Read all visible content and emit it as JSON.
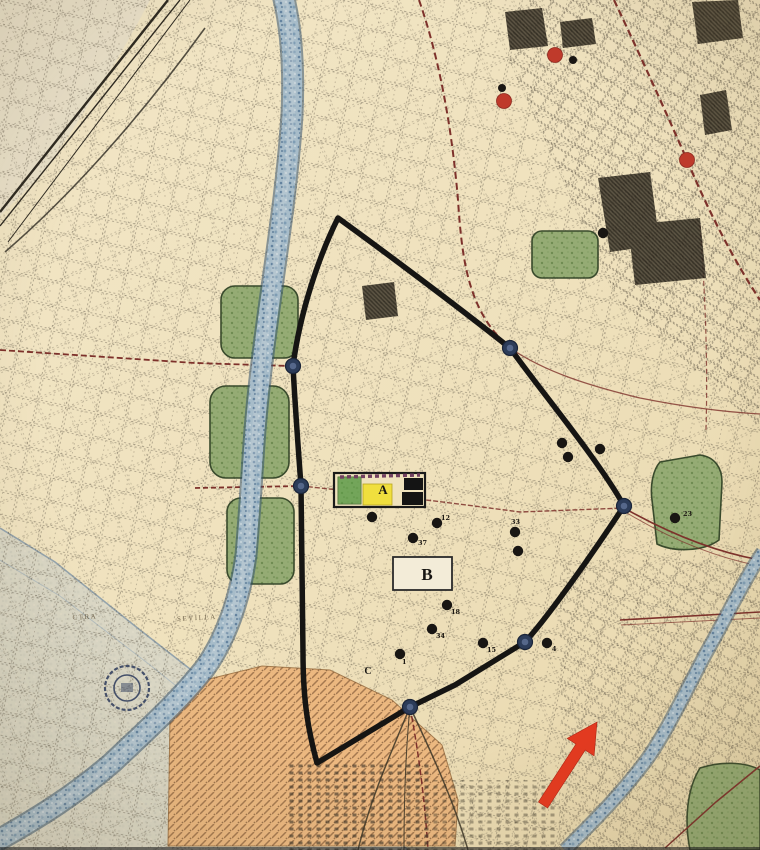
{
  "map": {
    "description": "scanned historical city map with walled old town outlined in black, river, riverside parks, annotated sites and a red arrow annotation",
    "letter_labels": [
      {
        "text": "A",
        "x": 383,
        "y": 494,
        "size": 13
      },
      {
        "text": "B",
        "x": 427,
        "y": 580,
        "size": 17
      },
      {
        "text": "C",
        "x": 368,
        "y": 674,
        "size": 10
      }
    ],
    "street_names": [
      {
        "text": "CTRA",
        "x": 85,
        "y": 619,
        "rot": -3
      },
      {
        "text": "SEVILLA",
        "x": 197,
        "y": 620,
        "rot": -3
      }
    ],
    "black_dots": [
      {
        "x": 372,
        "y": 517
      },
      {
        "x": 437,
        "y": 523,
        "label": "12",
        "dx": 4,
        "dy": -3
      },
      {
        "x": 413,
        "y": 538,
        "label": "37",
        "dx": 5,
        "dy": 7
      },
      {
        "x": 515,
        "y": 532,
        "label": "33",
        "dx": -4,
        "dy": -8
      },
      {
        "x": 518,
        "y": 551
      },
      {
        "x": 562,
        "y": 443
      },
      {
        "x": 568,
        "y": 457
      },
      {
        "x": 600,
        "y": 449
      },
      {
        "x": 447,
        "y": 605,
        "label": "18",
        "dx": 4,
        "dy": 9
      },
      {
        "x": 432,
        "y": 629,
        "label": "34",
        "dx": 4,
        "dy": 9
      },
      {
        "x": 483,
        "y": 643,
        "label": "15",
        "dx": 4,
        "dy": 9
      },
      {
        "x": 400,
        "y": 654,
        "label": "1",
        "dx": 2,
        "dy": 10
      },
      {
        "x": 547,
        "y": 643,
        "label": "4",
        "dx": 5,
        "dy": 8
      },
      {
        "x": 675,
        "y": 518,
        "label": "23",
        "dx": 8,
        "dy": -2
      },
      {
        "x": 603,
        "y": 233
      },
      {
        "x": 573,
        "y": 60,
        "r": 4
      },
      {
        "x": 502,
        "y": 88,
        "r": 4
      }
    ],
    "red_dots": [
      {
        "x": 555,
        "y": 55
      },
      {
        "x": 504,
        "y": 101
      },
      {
        "x": 687,
        "y": 160
      }
    ],
    "wall_nodes": [
      {
        "x": 293,
        "y": 366
      },
      {
        "x": 301,
        "y": 486
      },
      {
        "x": 510,
        "y": 348
      },
      {
        "x": 624,
        "y": 506
      },
      {
        "x": 525,
        "y": 642
      },
      {
        "x": 410,
        "y": 707
      }
    ],
    "arrow": {
      "tail_x": 543,
      "tail_y": 805,
      "tip_x": 597,
      "tip_y": 722
    },
    "colors": {
      "paper": "#efe1bc",
      "wall": "#161513",
      "node": "#2c3c59",
      "water": "#7f9db4",
      "park": "#95ab74",
      "district_orange": "#ecb77e",
      "road_maroon": "#7d312b",
      "poi_black": "#191613",
      "poi_red": "#bf3a2b",
      "arrow_red": "#e5391f",
      "box_yellow": "#f0df3e",
      "box_green": "#58a044"
    }
  }
}
